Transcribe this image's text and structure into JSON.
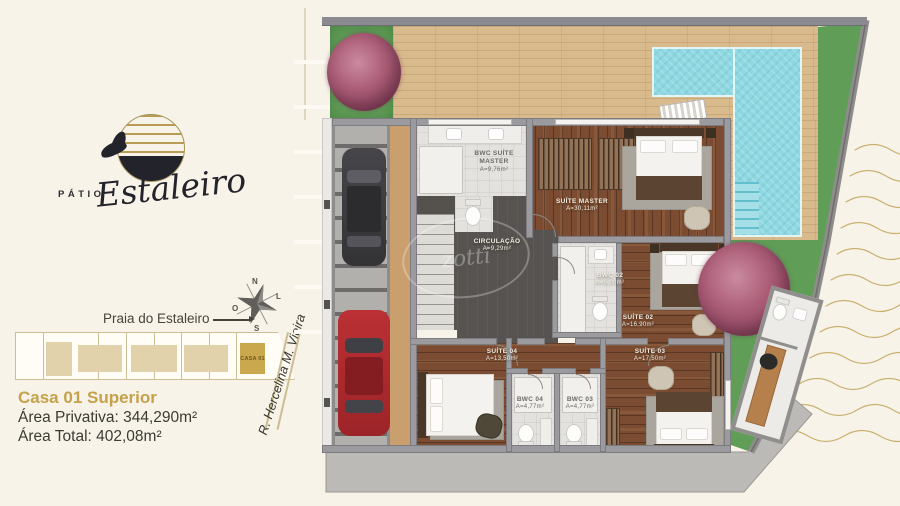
{
  "brand": {
    "prefix": "PÁTIO",
    "script": "Estaleiro"
  },
  "compass": {
    "north": "N",
    "south": "S",
    "east": "L",
    "west": "O"
  },
  "context": {
    "beach_street": "Praia do Estaleiro",
    "side_street": "R. Hercelina M. Vieira",
    "lot_label": "CASA 01"
  },
  "unit": {
    "title": "Casa 01 Superior",
    "private_area": "Área Privativa: 344,290m²",
    "total_area": "Área Total: 402,08m²"
  },
  "rooms": [
    {
      "name": "BWC SUÍTE MASTER",
      "area": "A=9,76m²"
    },
    {
      "name": "SUÍTE MASTER",
      "area": "A=30,11m²"
    },
    {
      "name": "CIRCULAÇÃO",
      "area": "A=9,29m²"
    },
    {
      "name": "BWC 02",
      "area": "A=5,00m²"
    },
    {
      "name": "SUÍTE 02",
      "area": "A=16,90m²"
    },
    {
      "name": "SUÍTE 04",
      "area": "A=13,50m²"
    },
    {
      "name": "SUÍTE 03",
      "area": "A=17,50m²"
    },
    {
      "name": "BWC 04",
      "area": "A=4,77m²"
    },
    {
      "name": "BWC 03",
      "area": "A=4,77m²"
    }
  ],
  "watermark": "zotti",
  "palette": {
    "background": "#f7f3e8",
    "accent_gold": "#c5a14b",
    "pool": "#8fd8e2",
    "deck_wood": "#d9ba8d",
    "floor_wood": "#7b4c31",
    "grass": "#609e57",
    "wall_gray": "#9b9a9e",
    "wave_gold": "#c3a65e"
  }
}
